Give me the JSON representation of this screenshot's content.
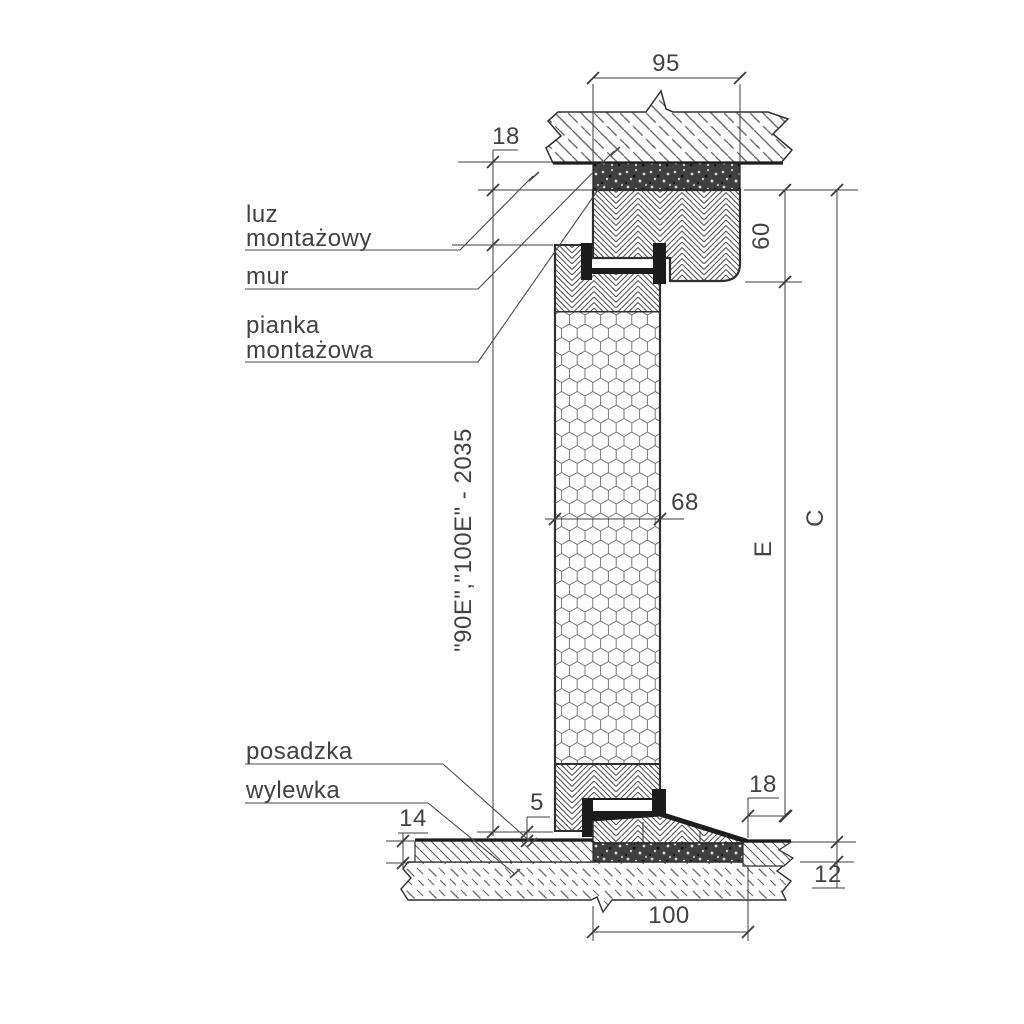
{
  "callouts": {
    "luz_line1": "luz",
    "luz_line2": "montażowy",
    "mur": "mur",
    "pianka_line1": "pianka",
    "pianka_line2": "montażowa",
    "posadzka": "posadzka",
    "wylewka": "wylewka"
  },
  "dims": {
    "top_width": "95",
    "top_clearance": "18",
    "frame_head_height": "60",
    "leaf_thickness": "68",
    "leaf_height": "\"90E\",\"100E\" - 2035",
    "opening_height": "E",
    "total_height": "C",
    "bottom_clearance": "5",
    "floor_finish_left": "14",
    "threshold_edge_offset": "18",
    "floor_finish_right": "12",
    "threshold_width": "100"
  },
  "colors": {
    "line": "#2f2f2f",
    "dimension_line": "#3c3c3c",
    "text": "#424242",
    "seal_black": "#1c1c1c",
    "foam_dark": "#3f3f3f",
    "background": "#ffffff"
  }
}
